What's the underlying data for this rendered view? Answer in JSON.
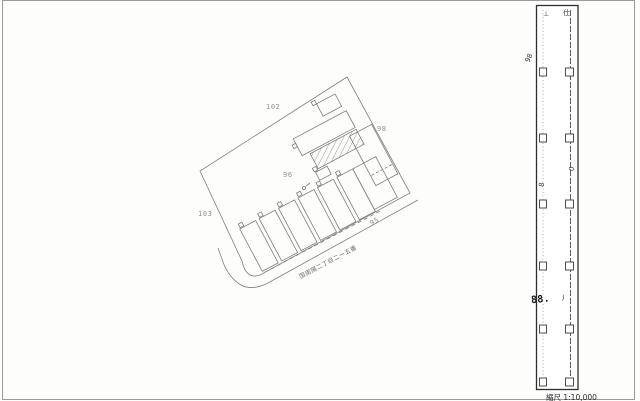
{
  "map": {
    "labels": {
      "lot_102": "102",
      "lot_98": "98",
      "lot_96": "96",
      "lot_103": "103",
      "lot_95": "95"
    },
    "street_label": "国南陽二丁目二ー五番"
  },
  "strip": {
    "glyph_top_left": "⊥",
    "glyph_top_right": "仕",
    "glyph_98": "98",
    "glyph_8": "8",
    "glyph_0": "0",
    "stamp_88": "88.",
    "paren_mark": ")",
    "scale_label": "縮尺 1:10,000"
  },
  "colors": {
    "drawing_line": "#7e7e7e",
    "label_text": "#8f8f8f",
    "strip_frame": "#2e2e2e",
    "stamp_text": "#151515",
    "page_border": "#9a9a9a"
  }
}
